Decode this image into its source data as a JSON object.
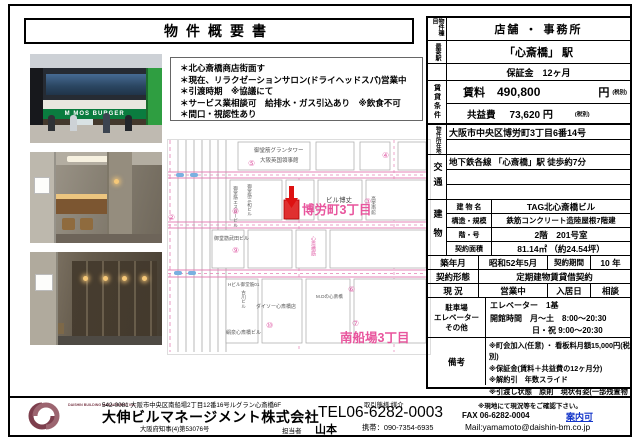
{
  "title": "物件概要書",
  "bullets": {
    "b0": "＊北心斎橋商店街面す",
    "b1": "＊現在、リラクゼーションサロン(ドライヘッドスパ)営業中",
    "b2": "＊引渡時期　※協議にて",
    "b3": "＊サービス業相談可　給排水・ガス引込あり　※飲食不可",
    "b4": "＊間口・視認性あり"
  },
  "photos": {
    "mos_sign": "M MOS BURGER"
  },
  "table": {
    "type_label": "物件種目",
    "type_value": "店舗 ・ 事務所",
    "station_label": "最寄駅",
    "station_value": "「心斎橋」 駅",
    "deposit_value": "保証金　12ヶ月",
    "rent_group_label": "賃貸条件",
    "rent_label": "賃料",
    "rent_value": "490,800",
    "rent_yen": "円",
    "rent_tax": "(税別)",
    "fee_label": "共益費",
    "fee_value": "73,620 円",
    "fee_tax": "(税別)",
    "addr_label": "物件所在地",
    "addr_value": "大阪市中央区博労町3丁目6番14号",
    "access_label": "交通",
    "access_value": "地下鉄各線 「心斎橋」駅  徒歩約7分",
    "bldg_label": "建物",
    "bldg_name_label": "建 物 名",
    "bldg_name": "TAG北心斎橋ビル",
    "structure_label": "構造・規模",
    "structure": "鉄筋コンクリート造陸屋根7階建",
    "floor_label": "階・号",
    "floor": "2階　201号室",
    "area_label": "契約面積",
    "area": "81.14㎡ （約24.54坪）",
    "built_label": "築年月",
    "built": "昭和52年5月",
    "term_label": "契約期間",
    "term": "10 年",
    "contract_label": "契約形態",
    "contract": "定期建物賃貸借契約",
    "status_label": "現 況",
    "status": "営業中",
    "movein_label": "入居日",
    "movein": "相談",
    "facility_label1": "駐車場",
    "facility_label2": "エレベーター",
    "facility_label3": "その他",
    "facility_line1": "エレベーター　1基",
    "facility_line2": "開館時間　月～土　8:00～20:30",
    "facility_line3": "日・祝  9:00～20:30",
    "notes_label": "備考",
    "note1": "※町会加入(任意) ・ 看板料月額15,000円(税別)",
    "note2": "※保証金(賃料＋共益費の12ヶ月分)",
    "note3": "※解約引　年数スライド",
    "note4": "※引渡し状態　原則　現状有姿(一部残置物有)"
  },
  "map": {
    "district1": "博労町3丁目",
    "district2": "南船場3丁目",
    "grand_tower": "御堂筋グランタワー",
    "consulate": "大阪英国領事館",
    "sg_bldg": "御堂筋エスジービル",
    "sanwa": "御堂筋三和ビル",
    "hakujo": "ビル博丈",
    "koei": "高栄南館",
    "takeda": "御堂筋武田ビル",
    "street": "心斎橋筋",
    "furukawa": "古川ビル",
    "daiso": "ダイソー心斎橋店",
    "kinsen": "絹泉心斎橋ビル",
    "hbldg": "Hビル御堂筋01",
    "mdk": "M.Dの心斎橋",
    "n2": "②",
    "n3": "③",
    "n4": "④",
    "n5": "⑤",
    "n6": "⑥",
    "n7": "⑦",
    "n8": "⑧",
    "n9": "⑨",
    "n10": "⑩"
  },
  "footer": {
    "zip_address": "542-0081 大阪市中央区南船場2丁目12番16号ルグラン心斎橋6F",
    "company": "大伸ビルマネージメント株式会社",
    "license": "大阪府知事(4)第53076号",
    "rep_label": "担当者",
    "rep": "山本",
    "tel": "TEL06-6282-0003",
    "mobile": "携帯：090-7354-6935",
    "deal_type": "取引態様:媒介",
    "onsite_note": "※現地にて現況等をご確認下さい。",
    "fax": "FAX 06-6282-0004",
    "guide": "案内可",
    "mail": "Mail:yamamoto@daishin-bm.co.jp",
    "logo_text": "DAISHIN BUILDING MANAGEMENT INC."
  }
}
